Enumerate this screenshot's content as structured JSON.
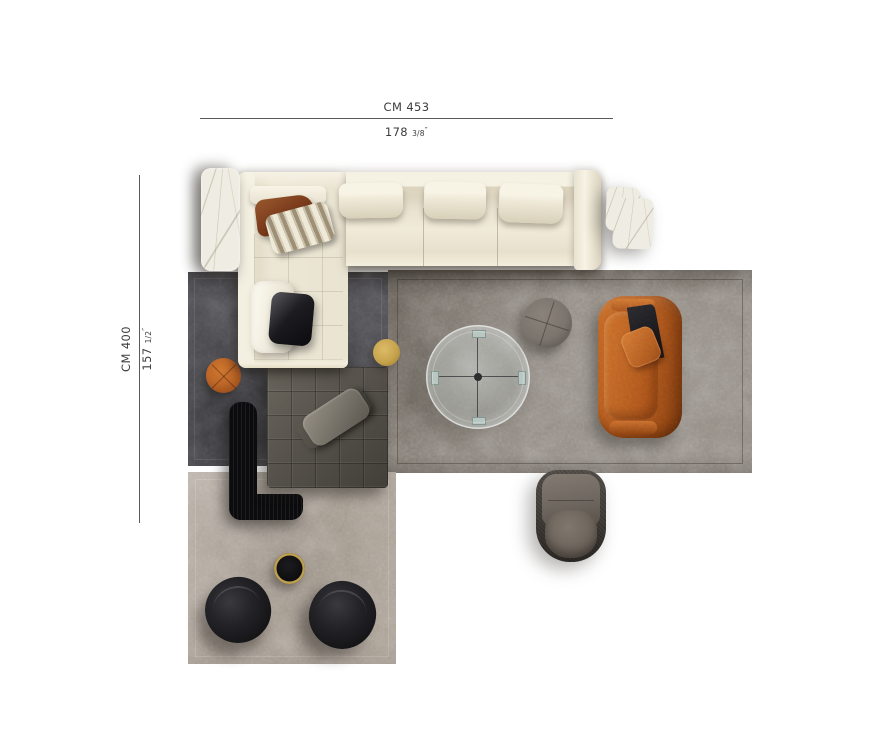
{
  "dimension_labels": {
    "horizontal": {
      "metric": "CM 453",
      "imperial_value": "178",
      "imperial_fraction": "3/8",
      "imperial_unit": "″"
    },
    "vertical": {
      "metric": "CM 400",
      "imperial_value": "157",
      "imperial_fraction": "1/2",
      "imperial_unit": "″"
    }
  },
  "colors": {
    "background": "#ffffff",
    "ink": "#3c3c3e",
    "line": "#59595b",
    "sofa-cream": "#ece6d5",
    "sofa-cream-bright": "#f7f3e5",
    "sofa-cream-shade": "#d8d0b9",
    "pillow-rust": "#7d3d1d",
    "pillow-black": "#1c1c20",
    "stripe-light": "#efe9d8",
    "stripe-dark": "#9d9077",
    "rug-dark": "#47464b",
    "rug-right": "#8c857d",
    "rug-bottom": "#a99f94",
    "daybed": "#57534c",
    "leather": "#7e7a70",
    "bench": "#0c0c0e",
    "pouf-orange": "#bd6628",
    "gold": "#c7a44e",
    "pouf-gray": "#7b746d",
    "sofa-orange": "#b45a1f",
    "throw": "#17171a",
    "armchair": "#6e6760",
    "chair-black": "#161619",
    "rim-gold": "#bd9f50",
    "marble": "#efece3",
    "glass": "#d6dfdb"
  }
}
